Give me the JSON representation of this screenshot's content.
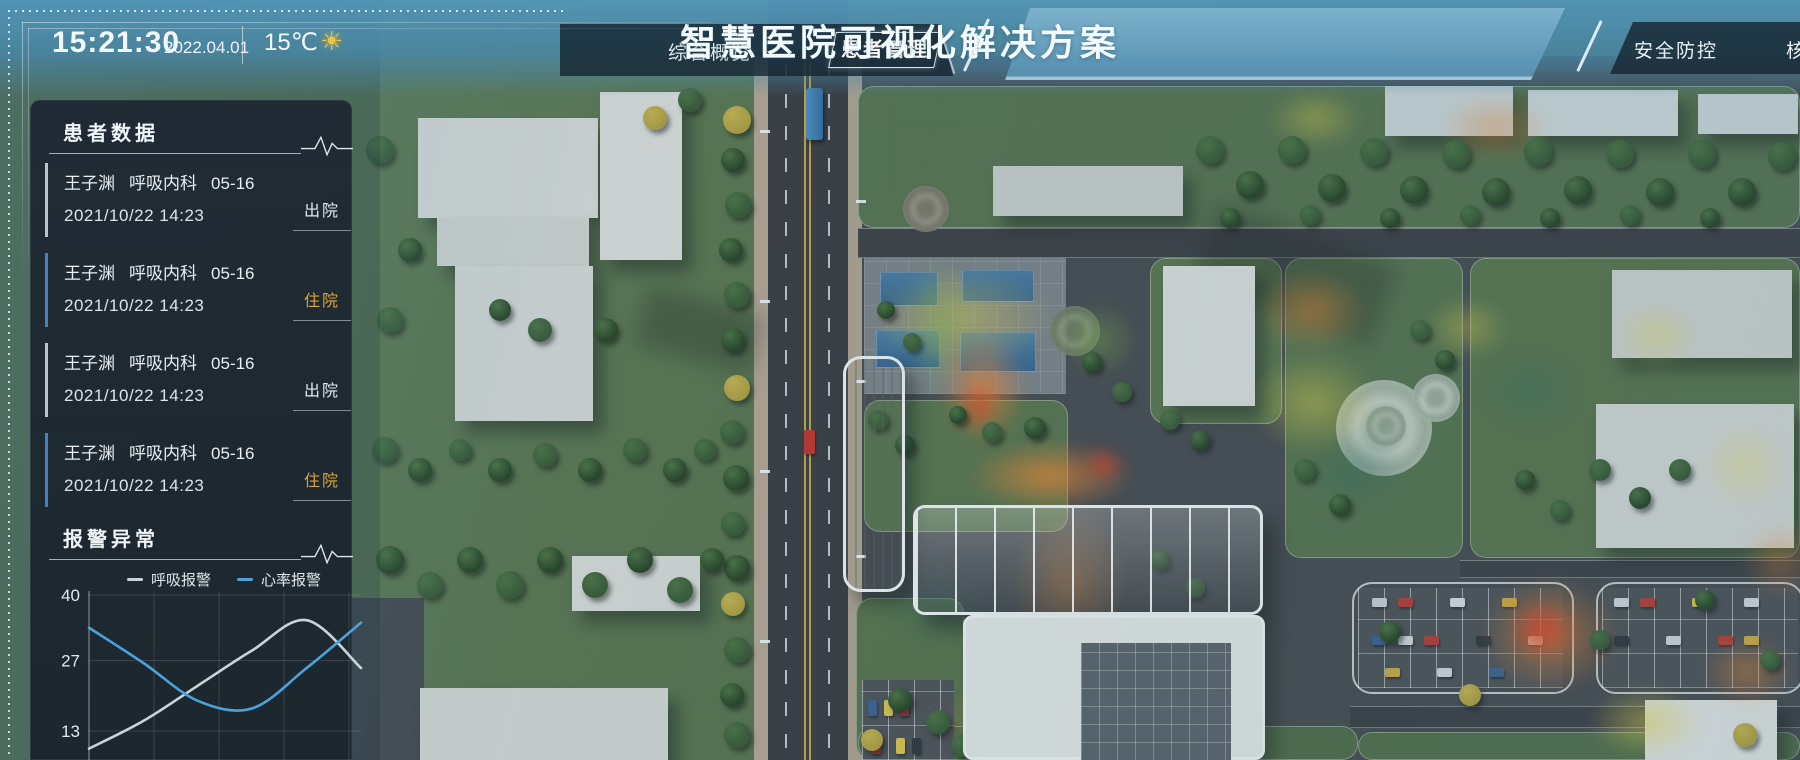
{
  "header": {
    "time": "15:21:30",
    "date": "2022.04.01",
    "temperature": "15℃",
    "weather_icon": "sun-icon",
    "title": "智慧医院可视化解决方案",
    "nav_left": [
      {
        "label": "综合概览",
        "active": false
      },
      {
        "label": "患者管理",
        "active": true
      }
    ],
    "nav_right": [
      {
        "label": "安全防控",
        "active": false
      },
      {
        "label": "核",
        "active": false,
        "note": "truncated at screen edge"
      }
    ]
  },
  "patient_panel": {
    "title": "患者数据",
    "icon": "pulse-icon",
    "patients": [
      {
        "name": "王子渊",
        "department": "呼吸内科",
        "bed": "05-16",
        "datetime": "2021/10/22 14:23",
        "status": "出院",
        "status_type": "discharged"
      },
      {
        "name": "王子渊",
        "department": "呼吸内科",
        "bed": "05-16",
        "datetime": "2021/10/22 14:23",
        "status": "住院",
        "status_type": "hospitalized"
      },
      {
        "name": "王子渊",
        "department": "呼吸内科",
        "bed": "05-16",
        "datetime": "2021/10/22 14:23",
        "status": "出院",
        "status_type": "discharged"
      },
      {
        "name": "王子渊",
        "department": "呼吸内科",
        "bed": "05-16",
        "datetime": "2021/10/22 14:23",
        "status": "住院",
        "status_type": "hospitalized"
      }
    ]
  },
  "alarm_panel": {
    "title": "报警异常",
    "icon": "pulse-icon",
    "legend": [
      {
        "label": "呼吸报警",
        "color": "#c9d4da"
      },
      {
        "label": "心率报警",
        "color": "#4aa3dc"
      }
    ]
  },
  "chart_data": {
    "type": "line",
    "x": [
      0,
      1,
      2,
      3,
      4,
      5
    ],
    "series": [
      {
        "name": "呼吸报警",
        "color": "#c9d4da",
        "values": [
          9.5,
          15,
          22,
          29,
          35,
          25.5
        ]
      },
      {
        "name": "心率报警",
        "color": "#4aa3dc",
        "values": [
          33.5,
          26.5,
          19,
          17.5,
          25.5,
          34.5
        ]
      }
    ],
    "yticks": [
      40,
      27,
      13
    ],
    "ylim": [
      0,
      40
    ],
    "grid": true,
    "legend_position": "top"
  },
  "colors": {
    "header_accent": "#5796bb",
    "panel_bg": "#1e2732",
    "status_hospitalized": "#d9a63c",
    "status_discharged": "#e3ebef",
    "item_border_hospitalized": "#3f83c4",
    "item_border_discharged": "#b9c6cc",
    "heatmap": [
      "#2e6b5e",
      "#7fb347",
      "#e8d545",
      "#f2862c",
      "#e83a1e"
    ]
  }
}
